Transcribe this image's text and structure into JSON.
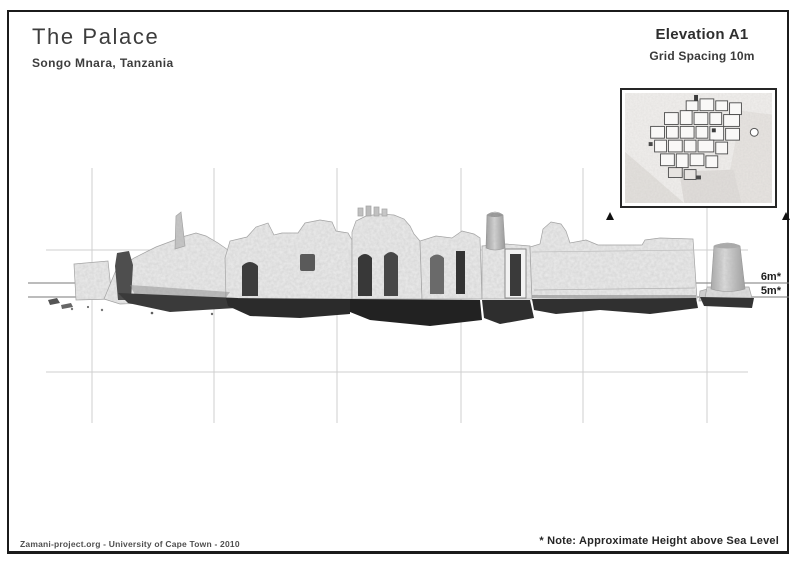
{
  "header": {
    "title": "The Palace",
    "subtitle": "Songo Mnara, Tanzania",
    "sheet_title": "Elevation A1",
    "sheet_subtitle": "Grid Spacing 10m"
  },
  "footer": {
    "credit": "Zamani-project.org - University of Cape Town - 2010",
    "note": "* Note: Approximate Height above Sea Level"
  },
  "elevation": {
    "height_labels": [
      {
        "label": "6m*"
      },
      {
        "label": "5m*"
      }
    ],
    "grid": {
      "spacing": "10m",
      "line_color": "#cfcfcf"
    },
    "reference_line_color": "#7a7a7a"
  }
}
